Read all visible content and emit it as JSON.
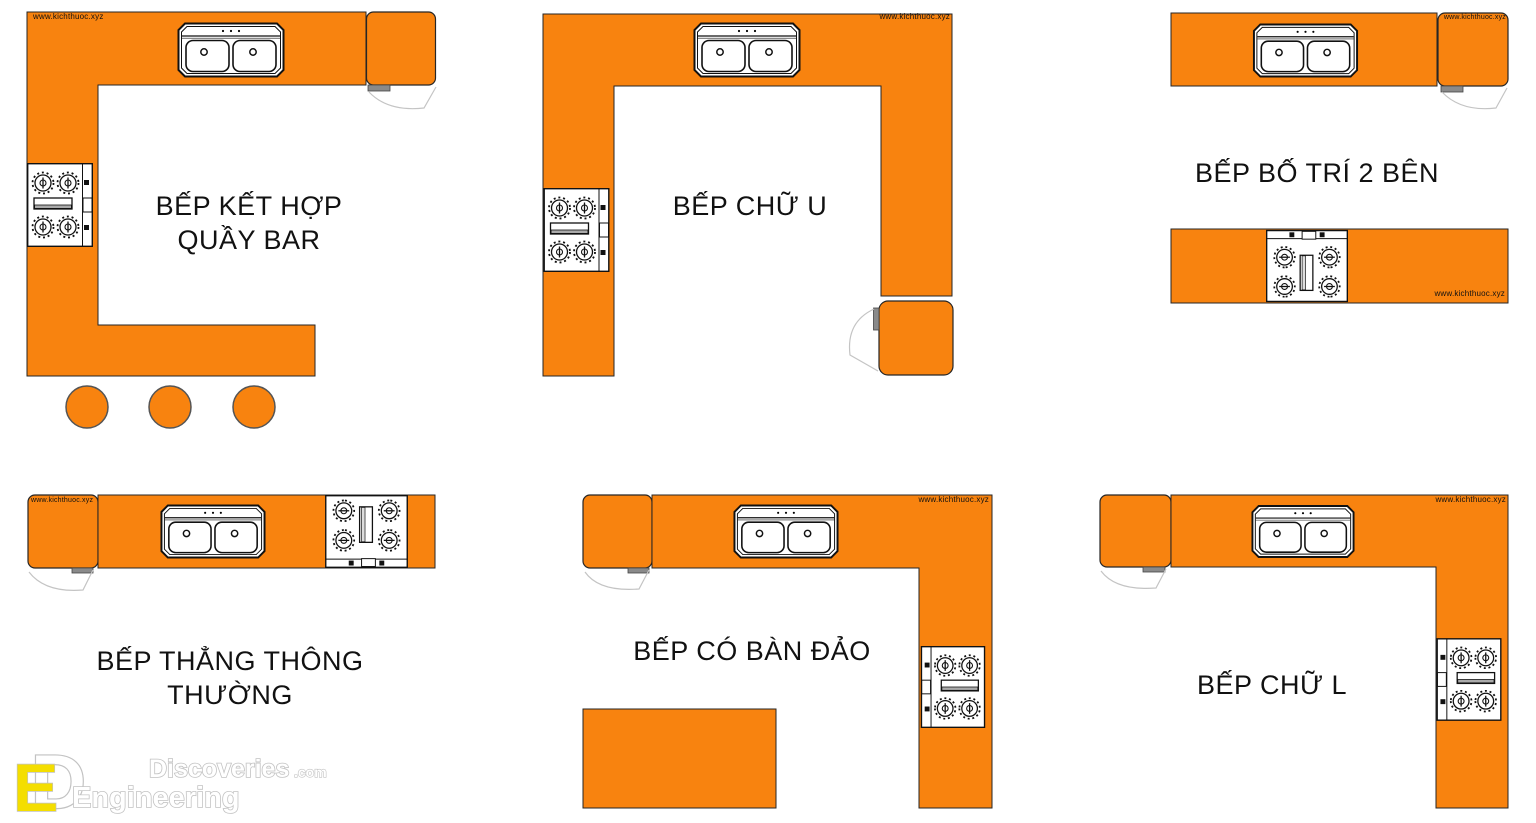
{
  "watermark": "www.kichthuoc.xyz",
  "colors": {
    "counter": "#F8830F",
    "outline": "#262626",
    "label_text": "#111111",
    "door_leaf": "#8A8A8A",
    "swing_line": "#C4C4C4",
    "logo_yellow": "#F4DE00",
    "logo_outline": "#C2C2C2"
  },
  "layouts": [
    {
      "title": "BẾP KẾT HỢP\nQUẦY BAR"
    },
    {
      "title": "BẾP CHỮ U"
    },
    {
      "title": "BẾP BỐ TRÍ 2 BÊN"
    },
    {
      "title": "BẾP THẲNG THÔNG THƯỜNG"
    },
    {
      "title": "BẾP CÓ BÀN ĐẢO"
    },
    {
      "title": "BẾP CHỮ L"
    }
  ],
  "icons": {
    "sink": "double-bowl-sink-icon",
    "cooktop": "four-burner-cooktop-icon",
    "stool": "bar-stool-icon",
    "door": "door-swing-icon"
  },
  "logo": {
    "monogram_e": "E",
    "monogram_d": "D",
    "discoveries": "Discoveries",
    "com_suffix": ".com",
    "engineering": "Engineering"
  }
}
